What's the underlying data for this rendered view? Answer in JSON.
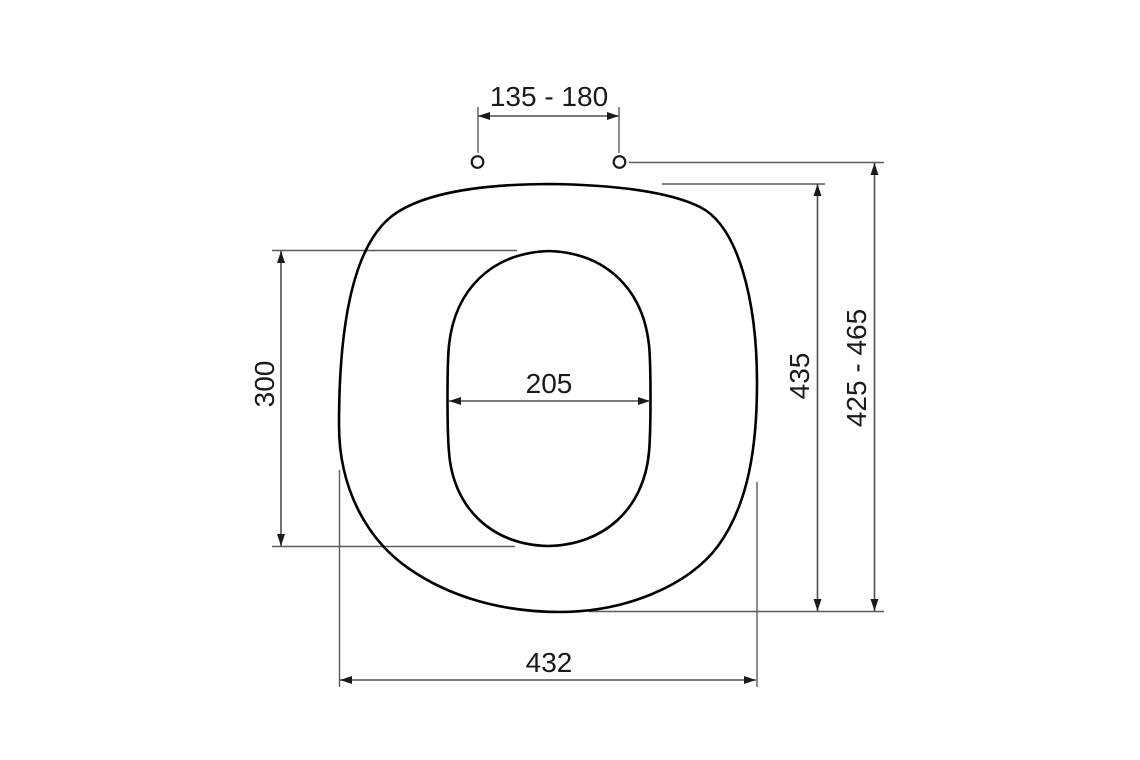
{
  "drawing": {
    "subject": "toilet-seat-top-view-dimension-drawing",
    "background_color": "#ffffff",
    "outline_color": "#000000",
    "dimension_line_color": "#4d4d4d",
    "text_color": "#1a1a1a",
    "dimensions": {
      "hinge_hole_spacing": {
        "label": "135 - 180",
        "orientation": "horizontal",
        "location": "top"
      },
      "cutout_length": {
        "label": "300",
        "orientation": "vertical",
        "location": "left"
      },
      "cutout_width": {
        "label": "205",
        "orientation": "horizontal",
        "location": "center"
      },
      "seat_depth": {
        "label": "435",
        "orientation": "vertical",
        "location": "right-inner"
      },
      "overall_depth_range": {
        "label": "425 - 465",
        "orientation": "vertical",
        "location": "right-outer"
      },
      "seat_width": {
        "label": "432",
        "orientation": "horizontal",
        "location": "bottom"
      }
    }
  }
}
